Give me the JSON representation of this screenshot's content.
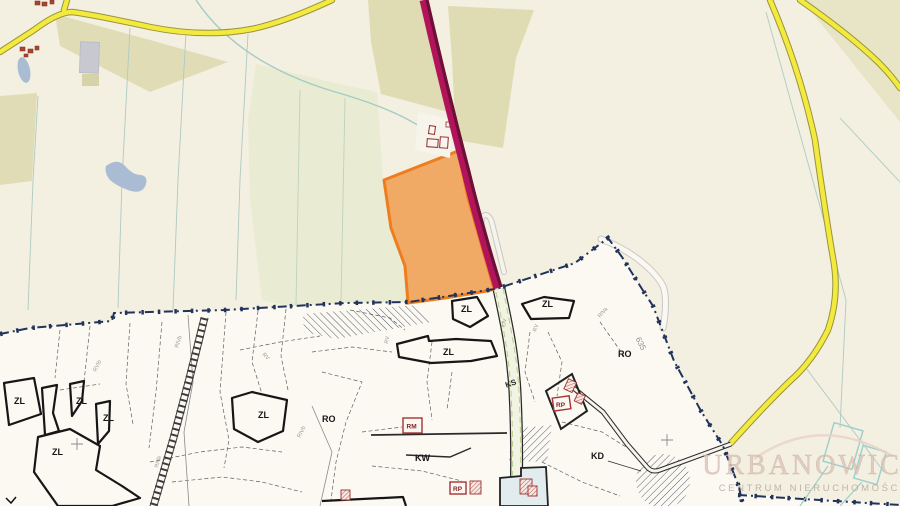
{
  "map": {
    "watermark": {
      "brand": "URBANOWICZ",
      "subtitle": "CENTRUM NIERUCHOMOŚCI"
    },
    "labels": {
      "zl": "ZL",
      "ro": "RO",
      "kw": "KW",
      "kd": "KD",
      "ks": "KS",
      "rm": "RM",
      "rp": "RP",
      "parcel_number": "635"
    },
    "soil_labels": [
      "RIVb",
      "RV",
      "RVIb",
      "RIVa",
      "RV",
      "RIVb",
      "RV",
      "RIVa",
      "ŁIV"
    ],
    "colors": {
      "background": "#f3efe1",
      "plan_background": "#fbf9f2",
      "highlight_parcel_fill": "#f0a053",
      "highlight_parcel_border": "#ee7d1f",
      "selected_road_fill": "#b2145b",
      "selected_road_edge": "#6d1037",
      "road_yellow": "#f4ea3e",
      "plan_boundary": "#22335a",
      "field_olive": "#e0ddb6",
      "field_pale_green": "#e9ecd2",
      "water_blue": "#a9bcd4",
      "parcel_line_teal": "#aecbc2",
      "building_red": "#a8452f"
    }
  }
}
